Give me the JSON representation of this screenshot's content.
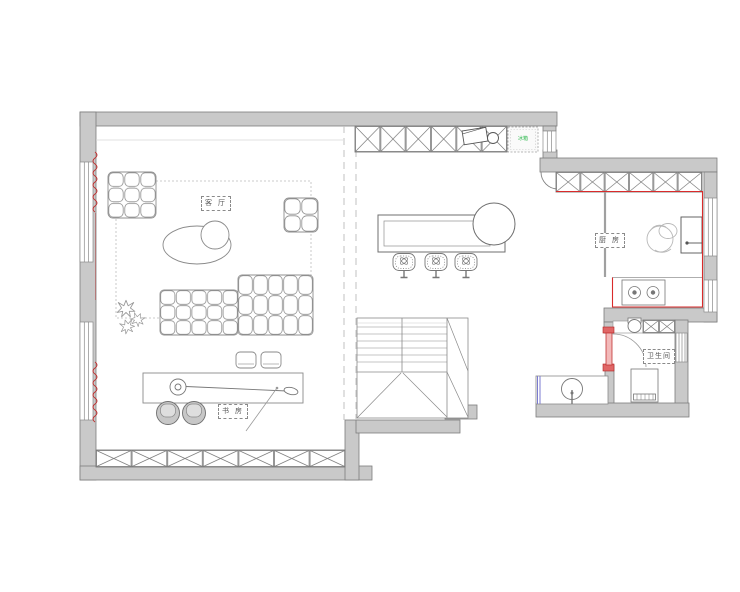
{
  "plan": {
    "title": "apartment-floor-plan",
    "rooms": {
      "living": {
        "label": "客 厅"
      },
      "study": {
        "label": "书 房"
      },
      "kitchen": {
        "label": "厨 房"
      },
      "bathroom": {
        "label": "卫生间"
      }
    },
    "appliances": {
      "fridge_label": "冰箱"
    },
    "colors": {
      "wall_fill": "#c9c9c9",
      "wall_line": "#7d7d7d",
      "furniture_line": "#8a8a8a",
      "counter_accent_red": "#d92b2b",
      "curtain_red": "#c03030",
      "glass_blue": "#7b7bd0",
      "appliance_green": "#2db84d",
      "dash_gray": "#c2c2c2"
    }
  }
}
